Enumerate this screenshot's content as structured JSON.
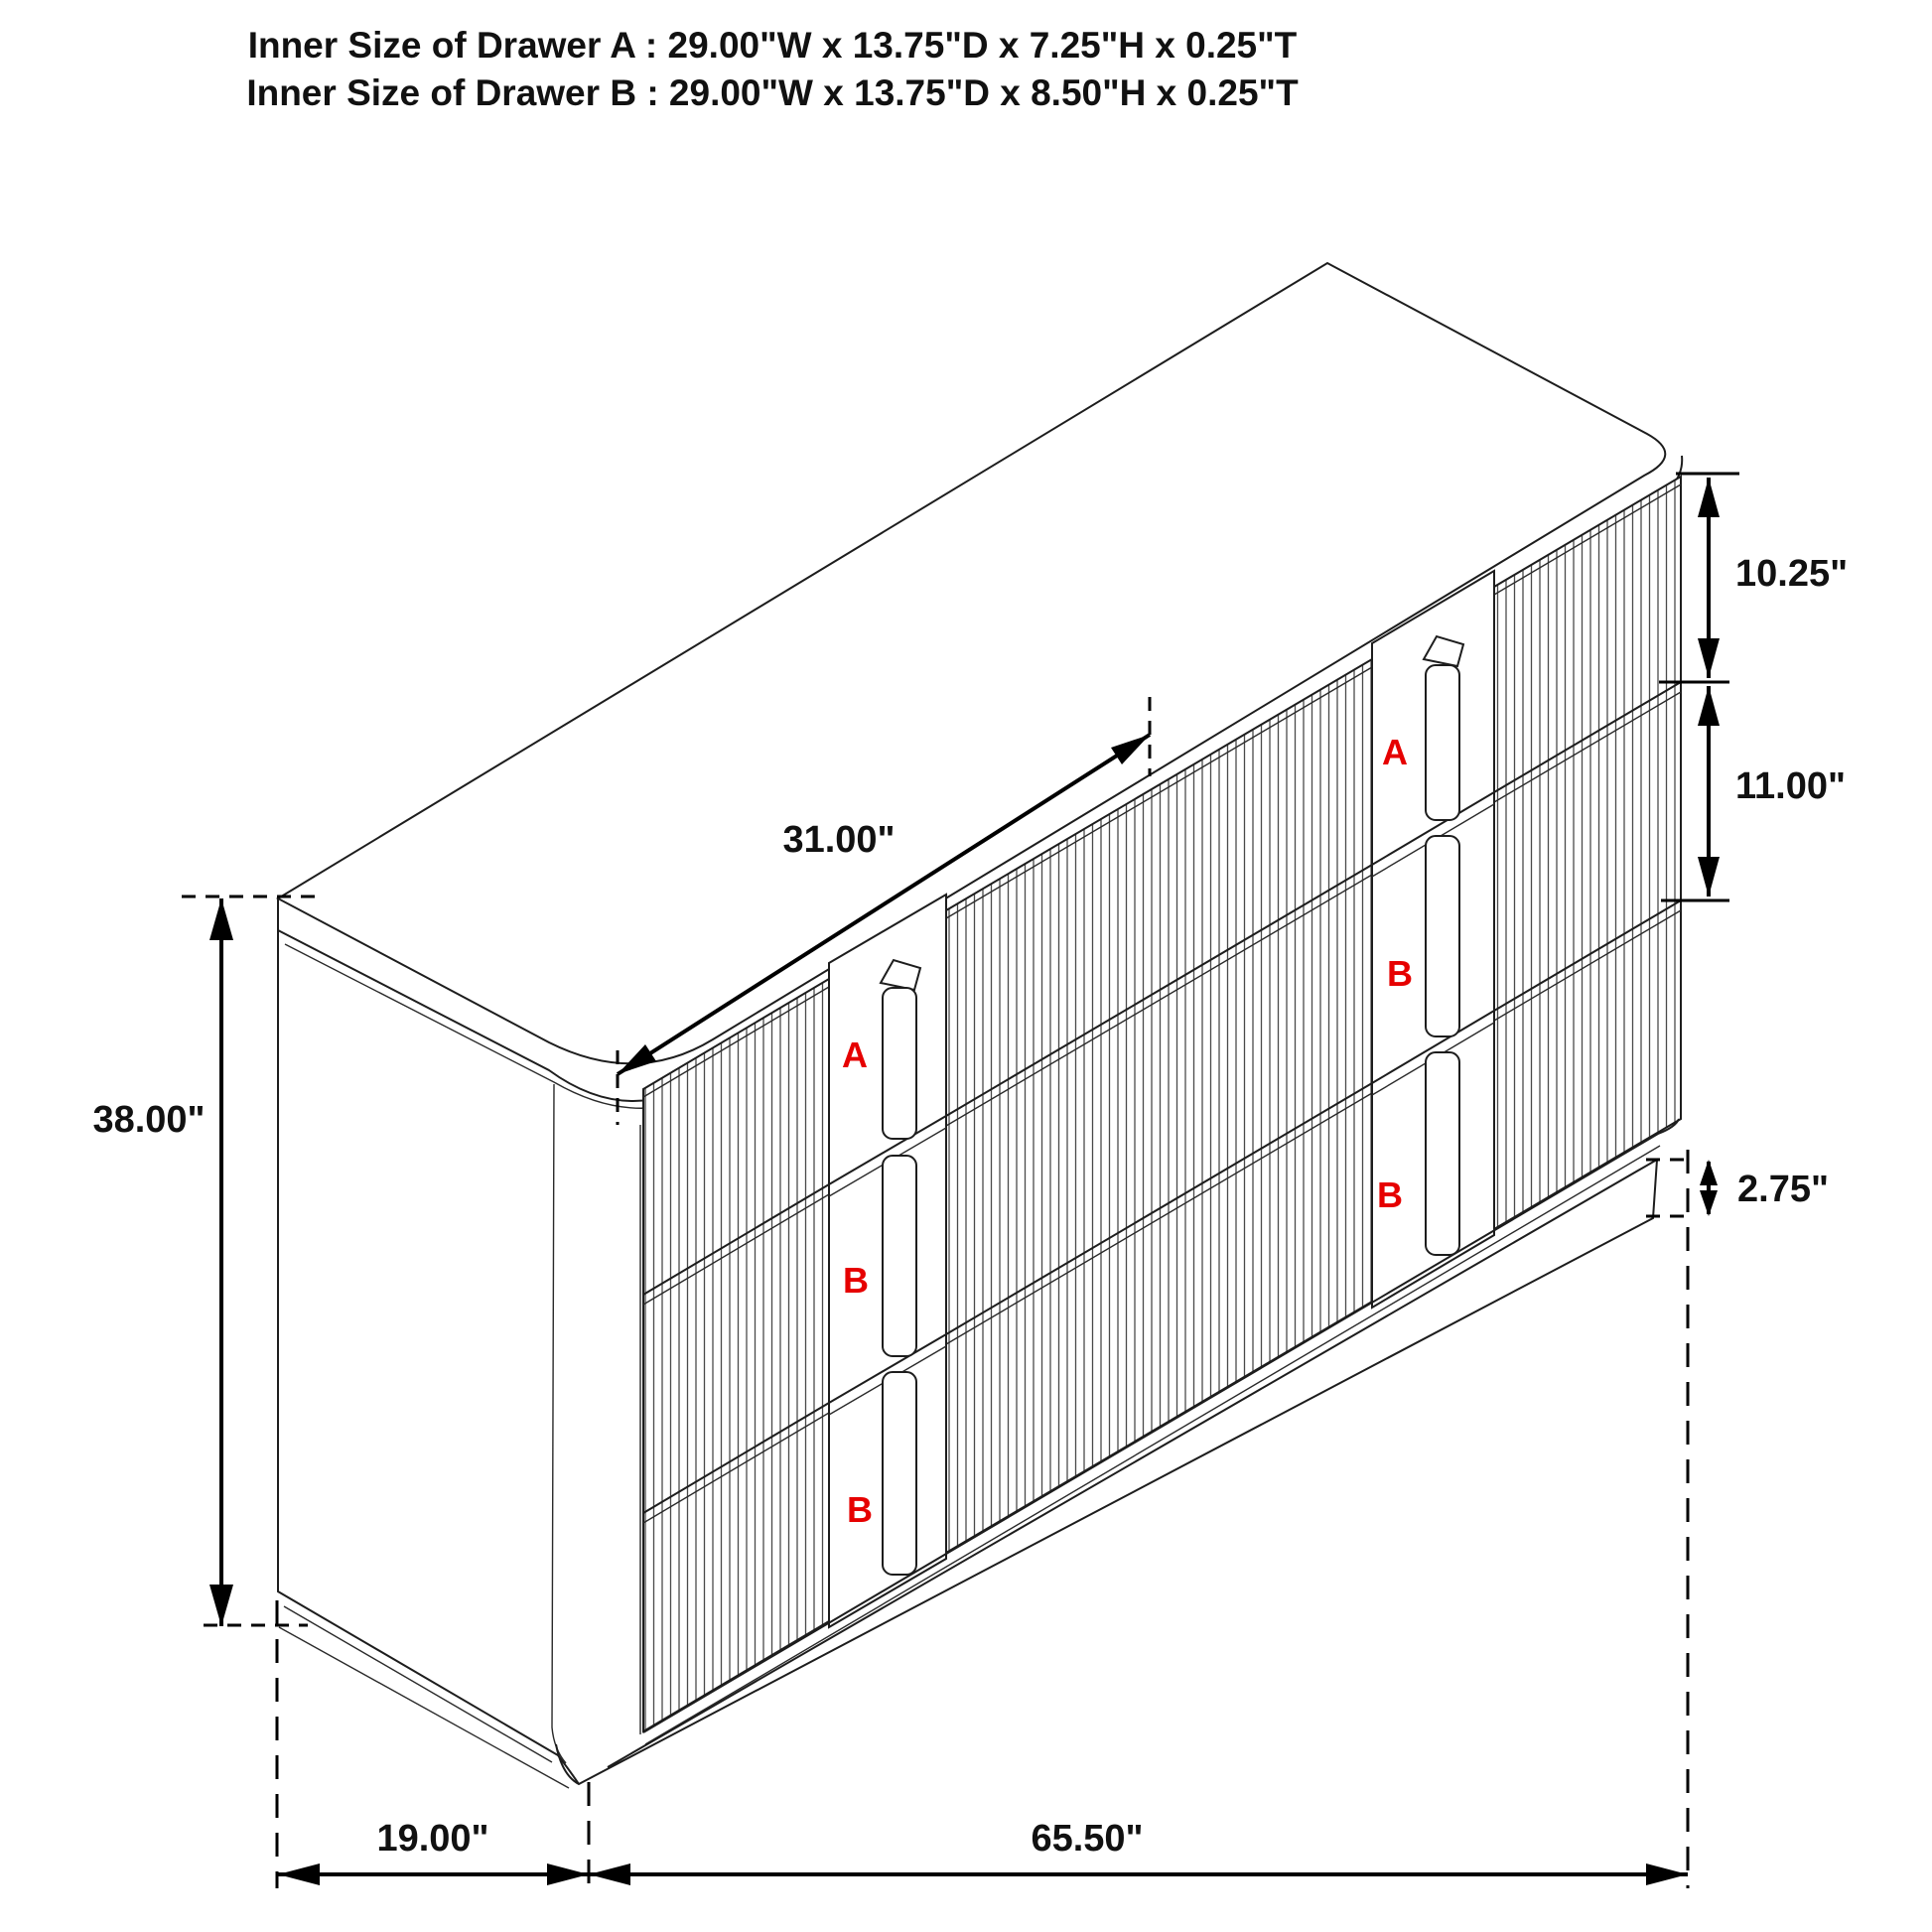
{
  "title": {
    "line1": "Inner Size of Drawer A : 29.00\"W x 13.75\"D x 7.25\"H x 0.25\"T",
    "line2": "Inner Size of Drawer B : 29.00\"W x 13.75\"D x 8.50\"H x 0.25\"T"
  },
  "dimensions": {
    "overall_height": "38.00\"",
    "overall_depth": "19.00\"",
    "overall_width": "65.50\"",
    "drawer_opening_width": "31.00\"",
    "top_drawer_front_height": "10.25\"",
    "lower_drawer_front_height": "11.00\"",
    "base_height": "2.75\""
  },
  "drawer_labels": {
    "left_bank": [
      "A",
      "B",
      "B"
    ],
    "right_bank": [
      "A",
      "B",
      "B"
    ]
  },
  "colors": {
    "line": "#1d1d1d",
    "label_red": "#e60000",
    "background": "#ffffff"
  }
}
